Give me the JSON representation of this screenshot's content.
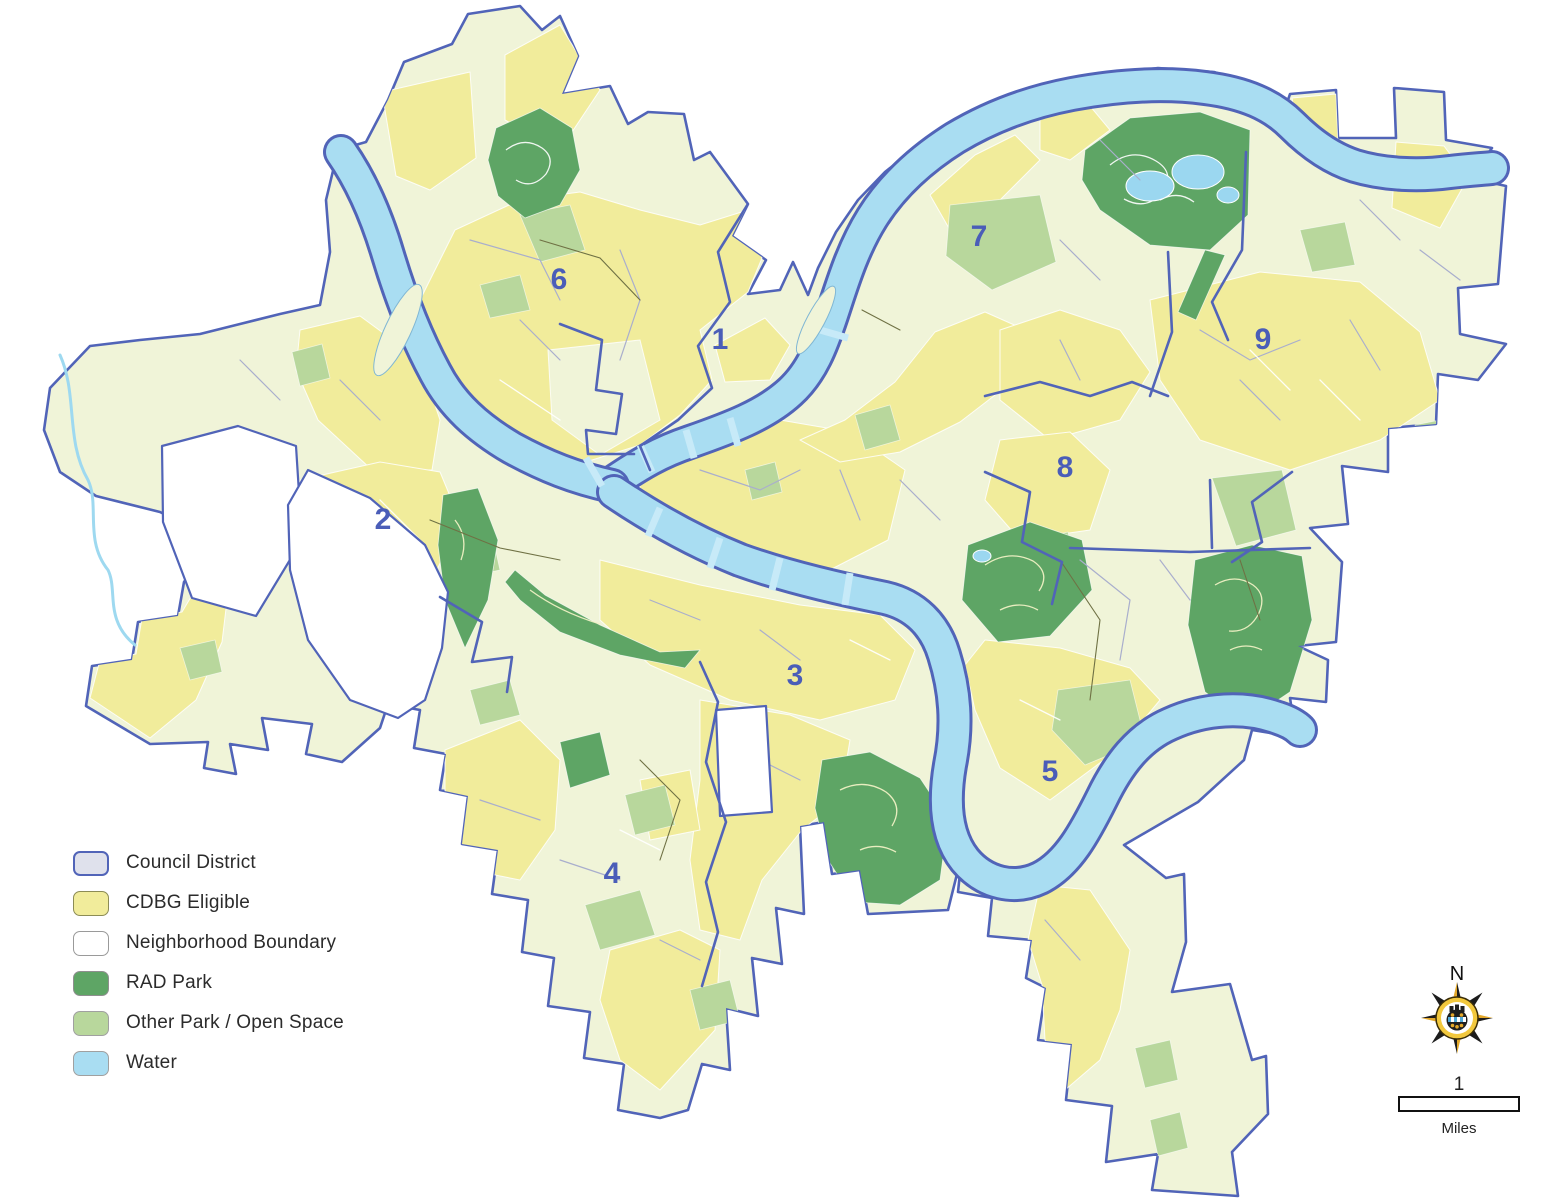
{
  "map": {
    "description": "City of Pittsburgh council districts with CDBG eligible areas, parks and rivers",
    "districts": [
      {
        "label": "1",
        "x": 720,
        "y": 349
      },
      {
        "label": "2",
        "x": 383,
        "y": 529
      },
      {
        "label": "3",
        "x": 795,
        "y": 685
      },
      {
        "label": "4",
        "x": 612,
        "y": 883
      },
      {
        "label": "5",
        "x": 1050,
        "y": 781
      },
      {
        "label": "6",
        "x": 559,
        "y": 289
      },
      {
        "label": "7",
        "x": 979,
        "y": 246
      },
      {
        "label": "8",
        "x": 1065,
        "y": 477
      },
      {
        "label": "9",
        "x": 1263,
        "y": 349
      }
    ],
    "colors": {
      "cdbg_eligible": "#f1ec9b",
      "neighborhood_fill": "#f0f4d8",
      "rad_park": "#5ea565",
      "other_park": "#b8d79c",
      "water": "#a9ddf2",
      "council_boundary": "#5164b8",
      "neighborhood_line": "#a9aecd",
      "municipal_line": "#6f7144",
      "district_label": "#4a5db8",
      "park_lake": "#9bd7f0",
      "outside": "#ffffff"
    }
  },
  "legend": {
    "items": [
      {
        "label": "Council District",
        "fill": "#dfe1ec",
        "border": "#5164b8",
        "border_width": 2.4
      },
      {
        "label": "CDBG Eligible",
        "fill": "#f1ec9b",
        "border": "#8c8c55",
        "border_width": 1.6
      },
      {
        "label": "Neighborhood Boundary",
        "fill": "#ffffff",
        "border": "#9a9a9a",
        "border_width": 1.4
      },
      {
        "label": "RAD Park",
        "fill": "#5ea565",
        "border": "#8f8f8f",
        "border_width": 1
      },
      {
        "label": "Other Park / Open Space",
        "fill": "#b8d79c",
        "border": "#a0a0a0",
        "border_width": 1
      },
      {
        "label": "Water",
        "fill": "#a9ddf2",
        "border": "#a0a0a0",
        "border_width": 1
      }
    ]
  },
  "compass": {
    "north_label": "N"
  },
  "scale_bar": {
    "distance_label": "1",
    "unit_label": "Miles"
  }
}
